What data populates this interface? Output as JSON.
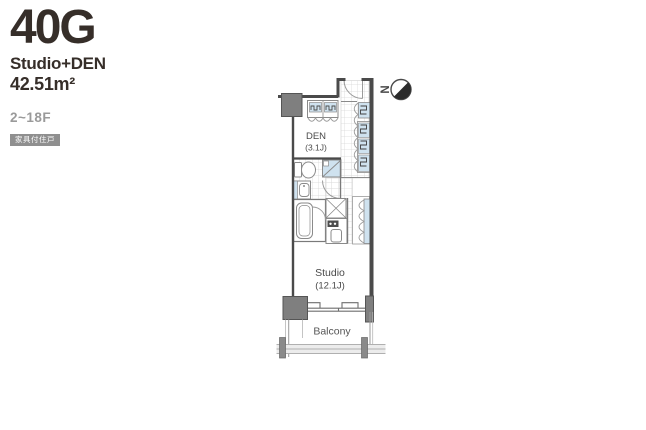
{
  "header": {
    "unit_id": "40G",
    "unit_type": "Studio+DEN",
    "area": "42.51m²",
    "floors": "2~18F",
    "badge": "家具付住戸"
  },
  "plan": {
    "den": {
      "name": "DEN",
      "size": "(3.1J)"
    },
    "studio": {
      "name": "Studio",
      "size": "(12.1J)"
    },
    "balcony": {
      "label": "Balcony"
    },
    "compass": {
      "label": "N"
    }
  },
  "colors": {
    "wall": "#4a4a4a",
    "pillar": "#7f7f7f",
    "fixture_outline": "#8a8a8a",
    "fixture_blue": "#cfe2ef",
    "tile_grid": "#d6d6d6",
    "text_dark": "#362e29",
    "muted_gray": "#9a9a9a",
    "badge_bg": "#8f8f8f"
  }
}
